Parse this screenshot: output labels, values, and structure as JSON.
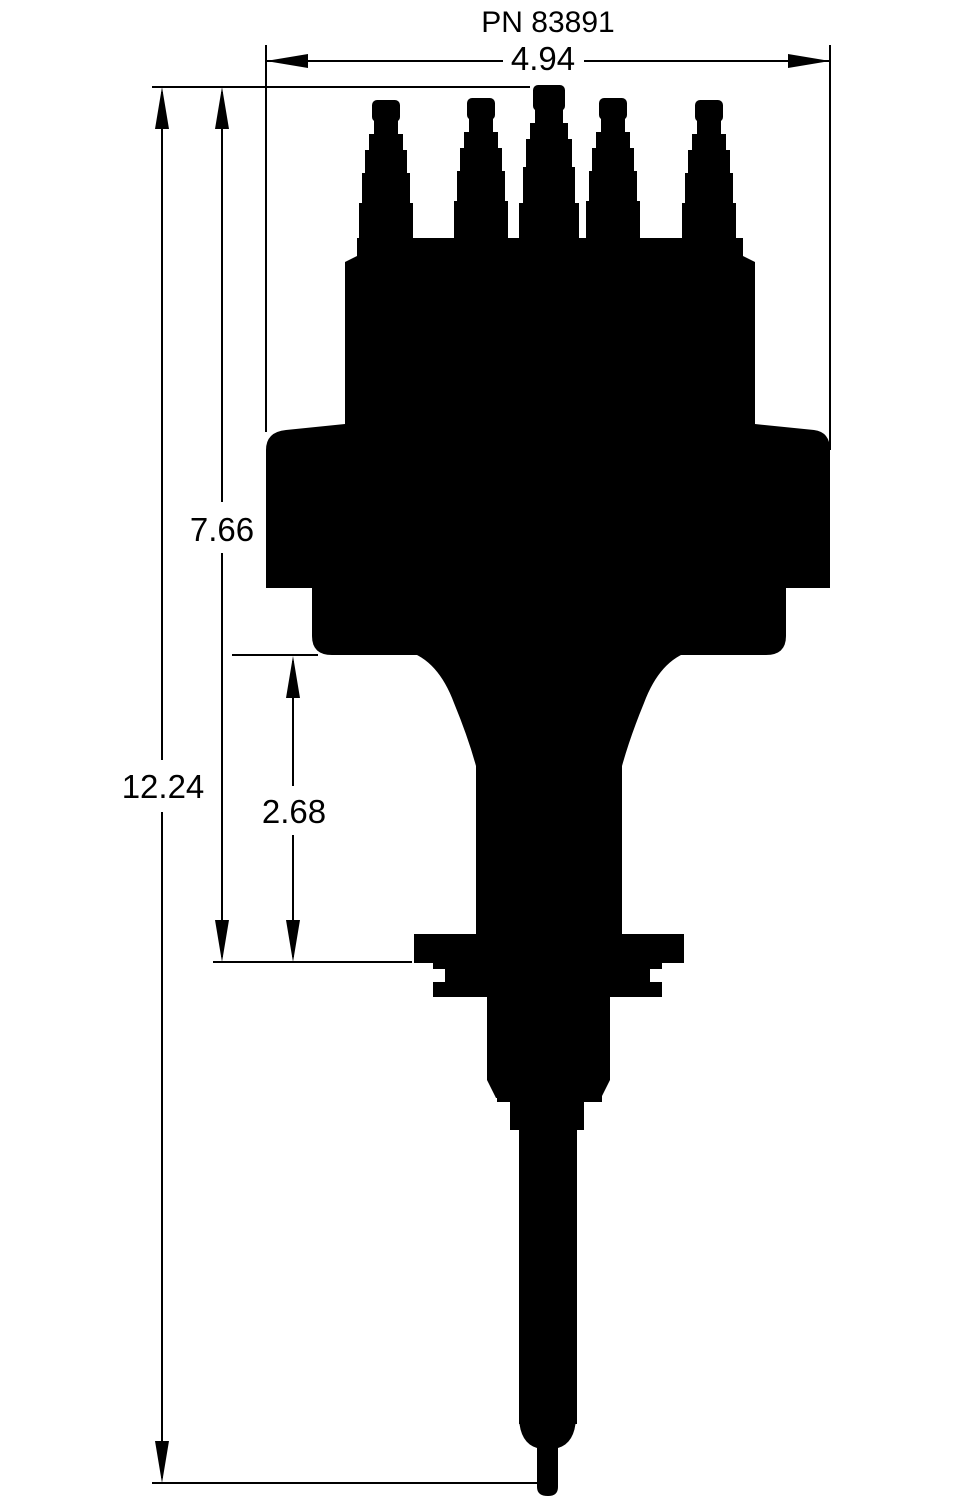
{
  "title": "PN 83891",
  "colors": {
    "ink": "#000000",
    "background": "#ffffff"
  },
  "dimensions": {
    "width": "4.94",
    "upper_height": "7.66",
    "overall_height": "12.24",
    "lower_height": "2.68"
  }
}
